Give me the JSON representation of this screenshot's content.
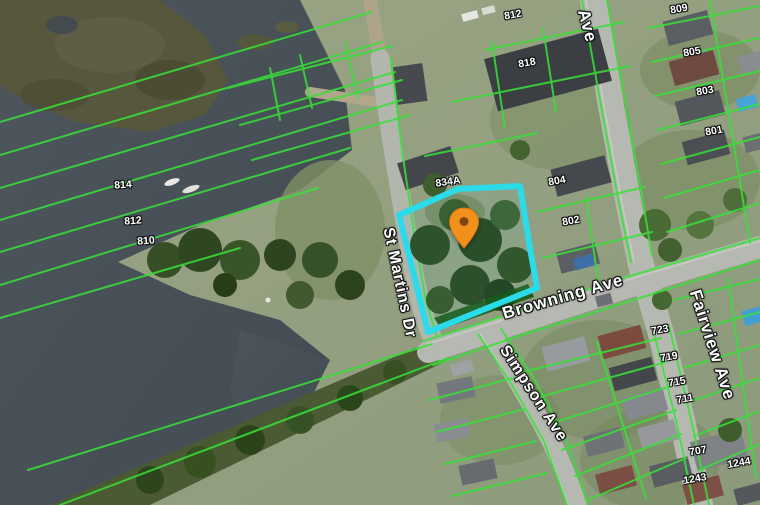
{
  "map": {
    "type": "aerial-cadastral-map",
    "colors": {
      "water": "#4a525a",
      "land": "#95a183",
      "road": "#b6b9b1",
      "parcel_line": "#38e138",
      "highlight_outline": "#2bdbe9",
      "pin": "#f28f1d",
      "label_text": "#ffffff"
    },
    "streets": [
      {
        "name": "St Martins Dr"
      },
      {
        "name": "Browning Ave"
      },
      {
        "name": "Simpson Ave"
      },
      {
        "name": "Fairview Ave"
      },
      {
        "name": "Ave"
      }
    ],
    "parcel_labels": [
      {
        "text": "814"
      },
      {
        "text": "812"
      },
      {
        "text": "810"
      },
      {
        "text": "834A"
      },
      {
        "text": "804"
      },
      {
        "text": "802"
      },
      {
        "text": "812"
      },
      {
        "text": "818"
      },
      {
        "text": "809"
      },
      {
        "text": "805"
      },
      {
        "text": "803"
      },
      {
        "text": "801"
      },
      {
        "text": "723"
      },
      {
        "text": "719"
      },
      {
        "text": "715"
      },
      {
        "text": "711"
      },
      {
        "text": "707"
      },
      {
        "text": "1243"
      },
      {
        "text": "1244"
      }
    ]
  }
}
